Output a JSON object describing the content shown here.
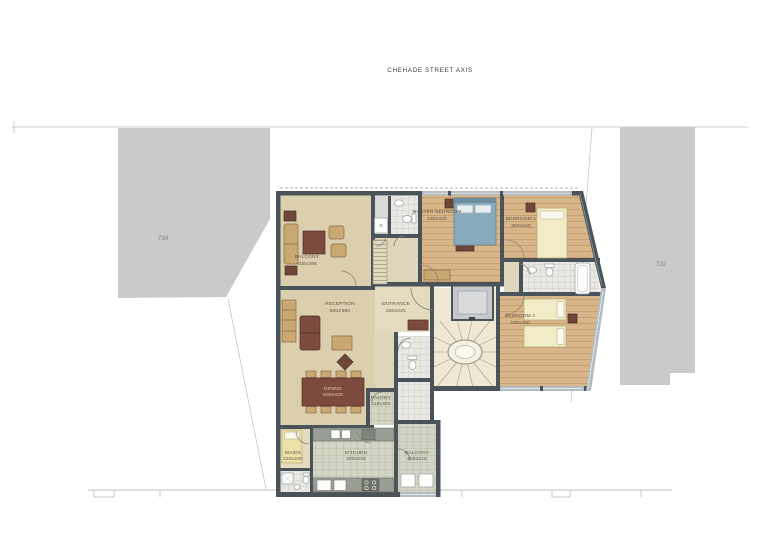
{
  "header": {
    "street_axis_label": "CHEHADE STREET AXIS"
  },
  "site": {
    "left_plot": "734",
    "right_plot": "732"
  },
  "rooms": {
    "balcony_top": {
      "label": "BALCONY",
      "dims": "400x395"
    },
    "master_bedroom": {
      "label": "MASTER BEDROOM",
      "dims": "435x340"
    },
    "bedroom_1": {
      "label": "BEDROOM 1",
      "dims": "360x340"
    },
    "bedroom_2": {
      "label": "BEDROOM 2",
      "dims": "400x350"
    },
    "reception": {
      "label": "RECEPTION",
      "dims": "500X380"
    },
    "entrance": {
      "label": "ENTRANCE",
      "dims": "280x225"
    },
    "dining": {
      "label": "DINING",
      "dims": "500x400"
    },
    "pantry": {
      "label": "PANTRY",
      "dims": "110x300"
    },
    "maids": {
      "label": "MAIDS",
      "dims": "220x240"
    },
    "kitchen": {
      "label": "KITCHEN",
      "dims": "400x240"
    },
    "balcony_bottom": {
      "label": "BALCONY",
      "dims": "400x210"
    }
  },
  "colors": {
    "wall": "#4a525a",
    "wood_floor": "#d9b68a",
    "beige_floor": "#dccfad",
    "tile_floor": "#d5d6c6",
    "window": "#b3bcc2",
    "neighbor_building": "#cacaca",
    "sofa_accent": "#7d4a3e",
    "bed_blue": "#87abbd"
  }
}
